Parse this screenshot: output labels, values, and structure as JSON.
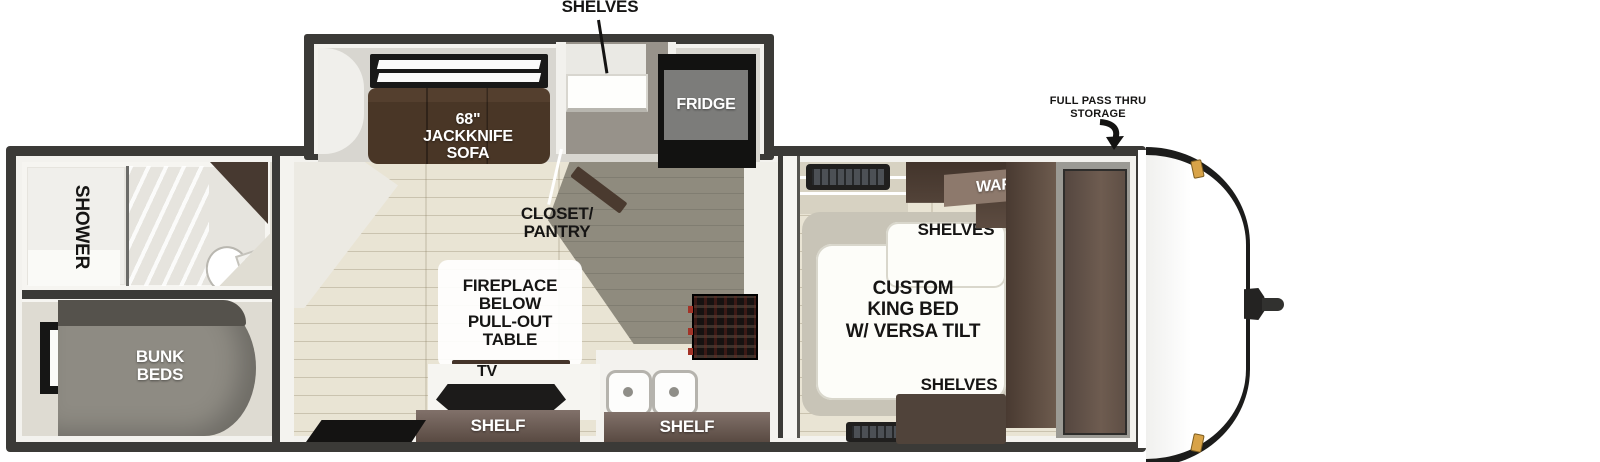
{
  "diagram": {
    "type": "travel-trailer-floorplan-top-view",
    "labels": {
      "shelves_callout": "SHELVES",
      "sofa": [
        "68\"",
        "JACKKNIFE",
        "SOFA"
      ],
      "fridge": "FRIDGE",
      "closet_pantry": [
        "CLOSET/",
        "PANTRY"
      ],
      "pass_thru": [
        "FULL PASS THRU",
        "STORAGE"
      ],
      "shower": "SHOWER",
      "bunk_beds": [
        "BUNK",
        "BEDS"
      ],
      "fireplace": [
        "FIREPLACE",
        "BELOW",
        "PULL-OUT TABLE"
      ],
      "tv": "TV",
      "shelf_left": "SHELF",
      "shelf_right": "SHELF",
      "ward": "WARD",
      "bed_shelves_top": "SHELVES",
      "bed_shelves_bottom": "SHELVES",
      "king_bed": [
        "CUSTOM",
        "KING BED",
        "W/ VERSA TILT"
      ]
    },
    "colors": {
      "wall_dark": "#3b3a37",
      "wood_floor": "#e9e4d4",
      "galley_floor": "#8f8b7e",
      "cabinet_brown": "#4e3f35",
      "sofa_brown": "#4c3929",
      "bunk_gray": "#8e8b83",
      "fridge_black": "#121211",
      "marker_light_amber": "#d8a348"
    }
  }
}
